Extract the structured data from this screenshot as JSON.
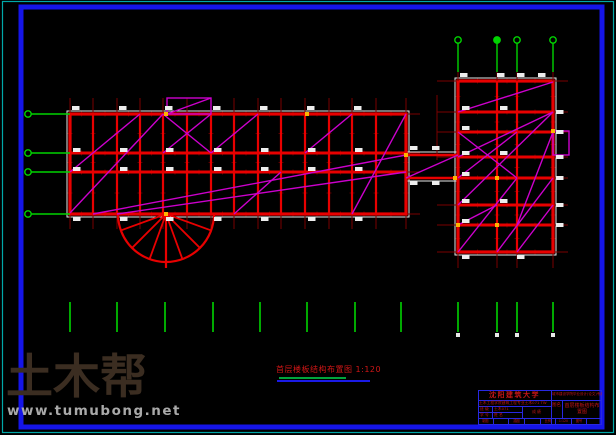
{
  "watermark": {
    "logo": "土木帮",
    "url": "www.tumubong.net",
    "logo_color": "#3b2d21",
    "url_color": "#a9a9a9"
  },
  "caption": {
    "text": "首层楼板结构布置图 1:120",
    "color": "#cf1616"
  },
  "titleblock": {
    "university": "沈阳建筑大学",
    "dept_line": "土木工程学院建筑工程专业土木071 TW",
    "org_line": "城市建设学院毕业设计(论文)专用纸",
    "row1_label": "班 级",
    "row1_value": "土木071",
    "row2_label": "学 号",
    "row2_value": "姓 名",
    "grade_label": "成 绩",
    "name_label": "图名",
    "drawing_name": "首层楼板结构布置图",
    "bottom_cells": [
      "制图",
      "",
      "描图",
      "",
      "比例",
      "1:120",
      "图号",
      ""
    ]
  },
  "drawing": {
    "colors": {
      "red": "#e80000",
      "dark_red": "#7a0000",
      "tick_red": "#6b0000",
      "magenta": "#cc00cc",
      "green": "#00d400",
      "white": "#e8e8e8",
      "label_fill": "#ededed",
      "yellow": "#ffb400",
      "blue_border": "#1515e8",
      "teal_border": "#00a8a8"
    },
    "left_grid": {
      "cols": [
        70,
        93,
        117,
        140,
        163,
        187,
        211,
        234,
        258,
        281,
        305,
        329,
        352,
        376,
        406
      ],
      "rows": [
        114,
        153,
        172,
        214
      ],
      "ext": {
        "top": 16,
        "bottom": 15,
        "left": 14,
        "right": 14
      }
    },
    "right_grid": {
      "cols": [
        458,
        497,
        517,
        553
      ],
      "rows": [
        81,
        112,
        132,
        157,
        178,
        205,
        225,
        252
      ],
      "ext": {
        "top": 17,
        "bottom": 16,
        "left": 21,
        "right": 15
      }
    },
    "corridor": {
      "x1": 406,
      "x2": 458,
      "y1": 155,
      "y2": 178
    },
    "circle": {
      "cx": 166,
      "cy": 214,
      "r": 48,
      "tail_y": 268,
      "spoke_angles": [
        20,
        45,
        70,
        90,
        110,
        135,
        160
      ]
    },
    "magenta_lines": [
      [
        70,
        213,
        163,
        114
      ],
      [
        70,
        172,
        140,
        114
      ],
      [
        93,
        214,
        406,
        155
      ],
      [
        117,
        214,
        406,
        172
      ],
      [
        163,
        153,
        211,
        114
      ],
      [
        163,
        114,
        211,
        153
      ],
      [
        211,
        153,
        258,
        114
      ],
      [
        305,
        153,
        352,
        114
      ],
      [
        352,
        214,
        406,
        114
      ],
      [
        234,
        214,
        281,
        172
      ],
      [
        167,
        114,
        211,
        98
      ],
      [
        406,
        178,
        458,
        155
      ],
      [
        458,
        112,
        553,
        82
      ],
      [
        458,
        157,
        553,
        112
      ],
      [
        458,
        178,
        517,
        132
      ],
      [
        458,
        132,
        517,
        178
      ],
      [
        458,
        252,
        517,
        178
      ],
      [
        497,
        252,
        553,
        178
      ],
      [
        517,
        252,
        553,
        205
      ],
      [
        458,
        225,
        497,
        205
      ],
      [
        458,
        205,
        553,
        112
      ],
      [
        517,
        225,
        553,
        132
      ]
    ],
    "magenta_rects": [
      [
        167,
        98,
        44,
        16
      ],
      [
        553,
        131,
        16,
        24
      ]
    ],
    "extra_dark_lines": [
      [
        437,
        95,
        437,
        160
      ]
    ],
    "left_leaders": {
      "circle_x": 28,
      "rows": [
        114,
        153,
        172,
        214
      ],
      "line_x2": 70
    },
    "top_leaders": {
      "circle_y": 40,
      "cols": [
        458,
        497,
        517,
        553
      ],
      "line_y2": 72,
      "grid_y": 81
    },
    "bottom_ticks": {
      "y1": 302,
      "y2": 332,
      "xs": [
        70,
        117,
        165,
        213,
        260,
        307,
        355,
        401,
        458,
        497,
        517,
        553
      ],
      "marker_xs": [
        458,
        497,
        517,
        553
      ]
    },
    "yellow_dots": [
      [
        166,
        114
      ],
      [
        307,
        114
      ],
      [
        406,
        155
      ],
      [
        455,
        178
      ],
      [
        497,
        178
      ],
      [
        458,
        225
      ],
      [
        497,
        225
      ],
      [
        166,
        214
      ],
      [
        553,
        131
      ]
    ],
    "corridor_labels": [
      [
        410,
        146
      ],
      [
        432,
        146
      ],
      [
        410,
        181
      ],
      [
        432,
        181
      ]
    ]
  }
}
